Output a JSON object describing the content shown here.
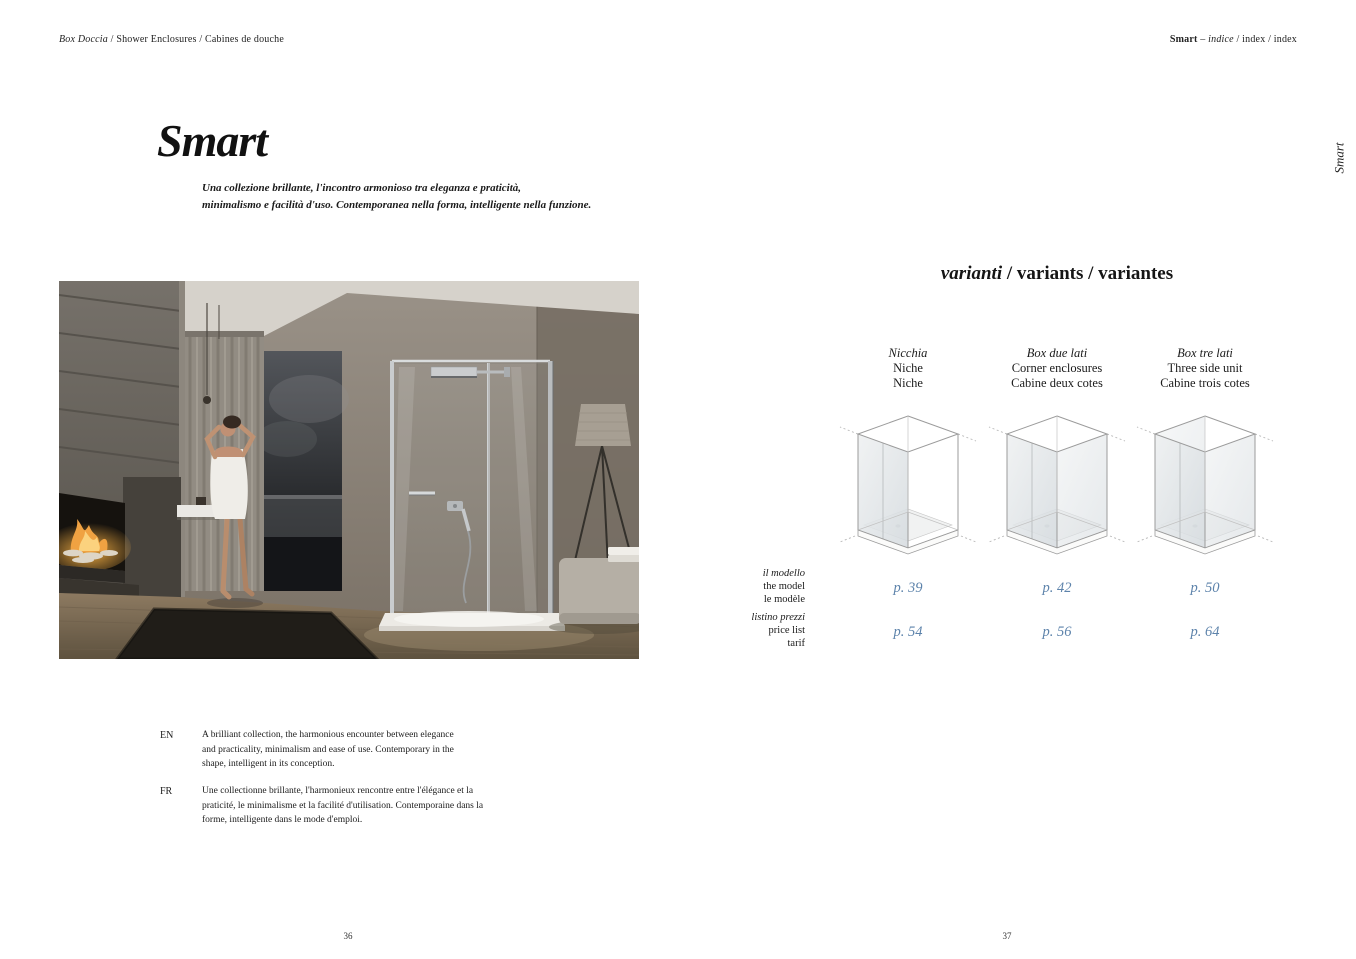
{
  "colors": {
    "accent_blue": "#5d83ab",
    "ink": "#1c1c1c",
    "wall_taupe": "#8a8379",
    "fire_orange": "#f0a242"
  },
  "header": {
    "breadcrumb_italic": "Box Doccia",
    "breadcrumb_rest": " / Shower Enclosures / Cabines de douche",
    "index_collection": "Smart",
    "index_dash": " – ",
    "index_italic": "indice",
    "index_rest": " / index / index"
  },
  "intro": {
    "title": "Smart",
    "subtitle_line1": "Una collezione brillante, l'incontro armonioso tra eleganza e praticità,",
    "subtitle_line2": "minimalismo e facilità d'uso. Contemporanea nella forma, intelligente nella funzione."
  },
  "variants": {
    "heading_italic": "varianti",
    "heading_rest": " / variants / variantes",
    "row_labels": {
      "model_it": "il modello",
      "model_en": "the model",
      "model_fr": "le modèle",
      "price_it": "listino prezzi",
      "price_en": "price list",
      "price_fr": "tarif"
    },
    "columns": [
      {
        "name_it": "Nicchia",
        "name_en": "Niche",
        "name_fr": "Niche",
        "model_page": "p. 39",
        "price_page": "p. 54"
      },
      {
        "name_it": "Box due lati",
        "name_en": "Corner enclosures",
        "name_fr": "Cabine deux cotes",
        "model_page": "p. 42",
        "price_page": "p. 56"
      },
      {
        "name_it": "Box tre lati",
        "name_en": "Three side unit",
        "name_fr": "Cabine trois cotes",
        "model_page": "p. 50",
        "price_page": "p. 64"
      }
    ]
  },
  "descriptions": {
    "en_label": "EN",
    "en_text": "A brilliant collection, the harmonious encounter between elegance and practicality, minimalism and ease of use. Contemporary in the shape, intelligent in its conception.",
    "fr_label": "FR",
    "fr_text": "Une collectionne brillante, l'harmonieux rencontre entre l'élégance et la praticité, le minimalisme et la facilité d'utilisation. Contemporaine dans la forme, intelligente dans le mode d'emploi."
  },
  "footer": {
    "page_left": "36",
    "page_right": "37"
  },
  "side_tab": "Smart"
}
